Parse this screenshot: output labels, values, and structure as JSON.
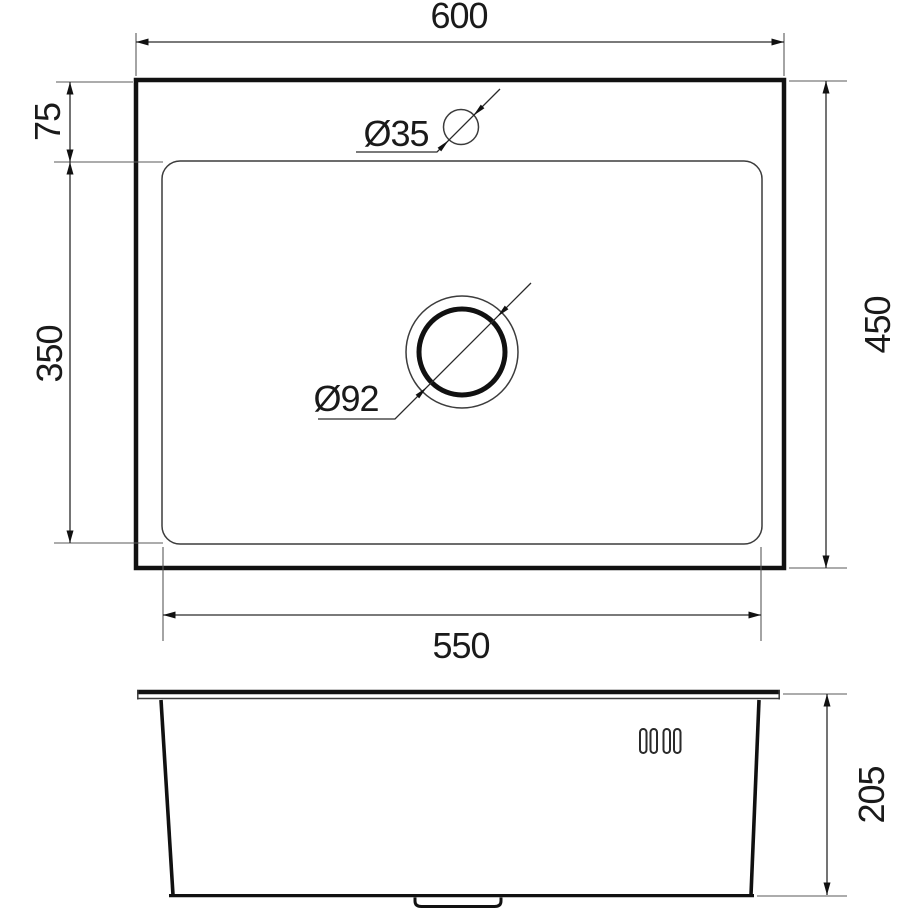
{
  "drawing": {
    "type": "sink-technical-drawing",
    "background_color": "#ffffff",
    "line_color": "#1a1a1a",
    "top_view": {
      "overall_width_mm": "600",
      "overall_depth_mm": "450",
      "bowl_width_mm": "550",
      "bowl_depth_mm": "350",
      "faucet_center_offset_mm": "75",
      "faucet_hole_diameter": "Ø35",
      "drain_hole_diameter": "Ø92"
    },
    "side_view": {
      "bowl_height_mm": "205"
    }
  }
}
